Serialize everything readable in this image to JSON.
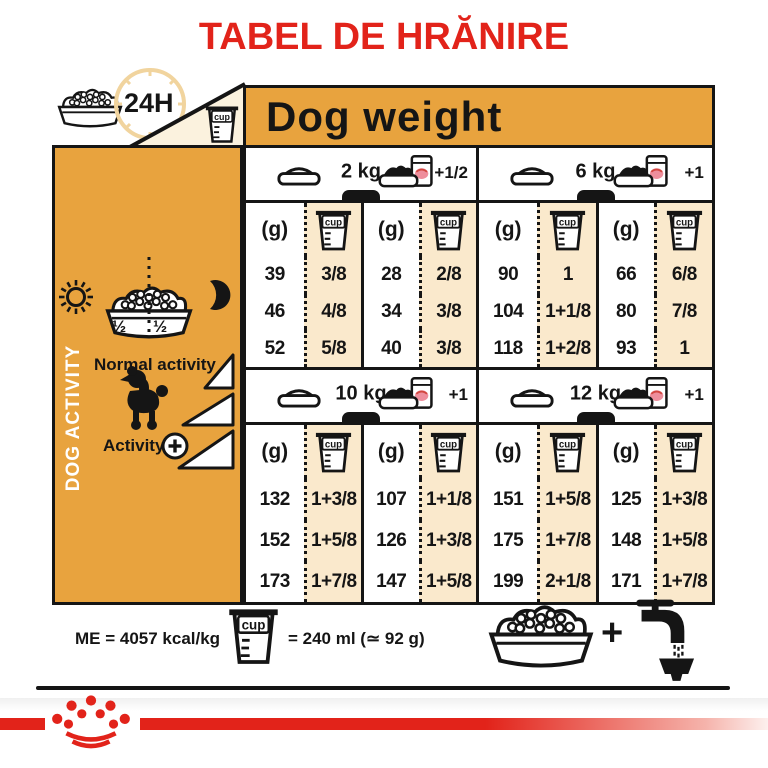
{
  "title": "TABEL DE HRĂNIRE",
  "header": {
    "hours_label": "24H",
    "dog_weight_label": "Dog weight"
  },
  "sidebar": {
    "vertical_label": "DOG ACTIVITY",
    "bowl_half_left": "½",
    "bowl_half_right": "½",
    "normal_activity_label": "Normal activity",
    "activity_label": "Activity"
  },
  "table": {
    "gram_header": "(g)",
    "cup_label": "cup",
    "sections": [
      {
        "weight": "2 kg",
        "extra": "+1/2",
        "rows": [
          {
            "g1": "39",
            "cup1": "3/8",
            "g2": "28",
            "cup2": "2/8"
          },
          {
            "g1": "46",
            "cup1": "4/8",
            "g2": "34",
            "cup2": "3/8"
          },
          {
            "g1": "52",
            "cup1": "5/8",
            "g2": "40",
            "cup2": "3/8"
          }
        ]
      },
      {
        "weight": "6 kg",
        "extra": "+1",
        "rows": [
          {
            "g1": "90",
            "cup1": "1",
            "g2": "66",
            "cup2": "6/8"
          },
          {
            "g1": "104",
            "cup1": "1+1/8",
            "g2": "80",
            "cup2": "7/8"
          },
          {
            "g1": "118",
            "cup1": "1+2/8",
            "g2": "93",
            "cup2": "1"
          }
        ]
      },
      {
        "weight": "10 kg",
        "extra": "+1",
        "rows": [
          {
            "g1": "132",
            "cup1": "1+3/8",
            "g2": "107",
            "cup2": "1+1/8"
          },
          {
            "g1": "152",
            "cup1": "1+5/8",
            "g2": "126",
            "cup2": "1+3/8"
          },
          {
            "g1": "173",
            "cup1": "1+7/8",
            "g2": "147",
            "cup2": "1+5/8"
          }
        ]
      },
      {
        "weight": "12 kg",
        "extra": "+1",
        "rows": [
          {
            "g1": "151",
            "cup1": "1+5/8",
            "g2": "125",
            "cup2": "1+3/8"
          },
          {
            "g1": "175",
            "cup1": "1+7/8",
            "g2": "148",
            "cup2": "1+5/8"
          },
          {
            "g1": "199",
            "cup1": "2+1/8",
            "g2": "171",
            "cup2": "1+7/8"
          }
        ]
      }
    ]
  },
  "footer": {
    "me_label": "ME = 4057 kcal/kg",
    "cup_equals_label": "= 240 ml (≃ 92 g)",
    "plus_sign": "+"
  },
  "colors": {
    "accent_red": "#E2231A",
    "orange": "#E8A33E",
    "cream": "#FAE9CC",
    "black": "#151515"
  }
}
